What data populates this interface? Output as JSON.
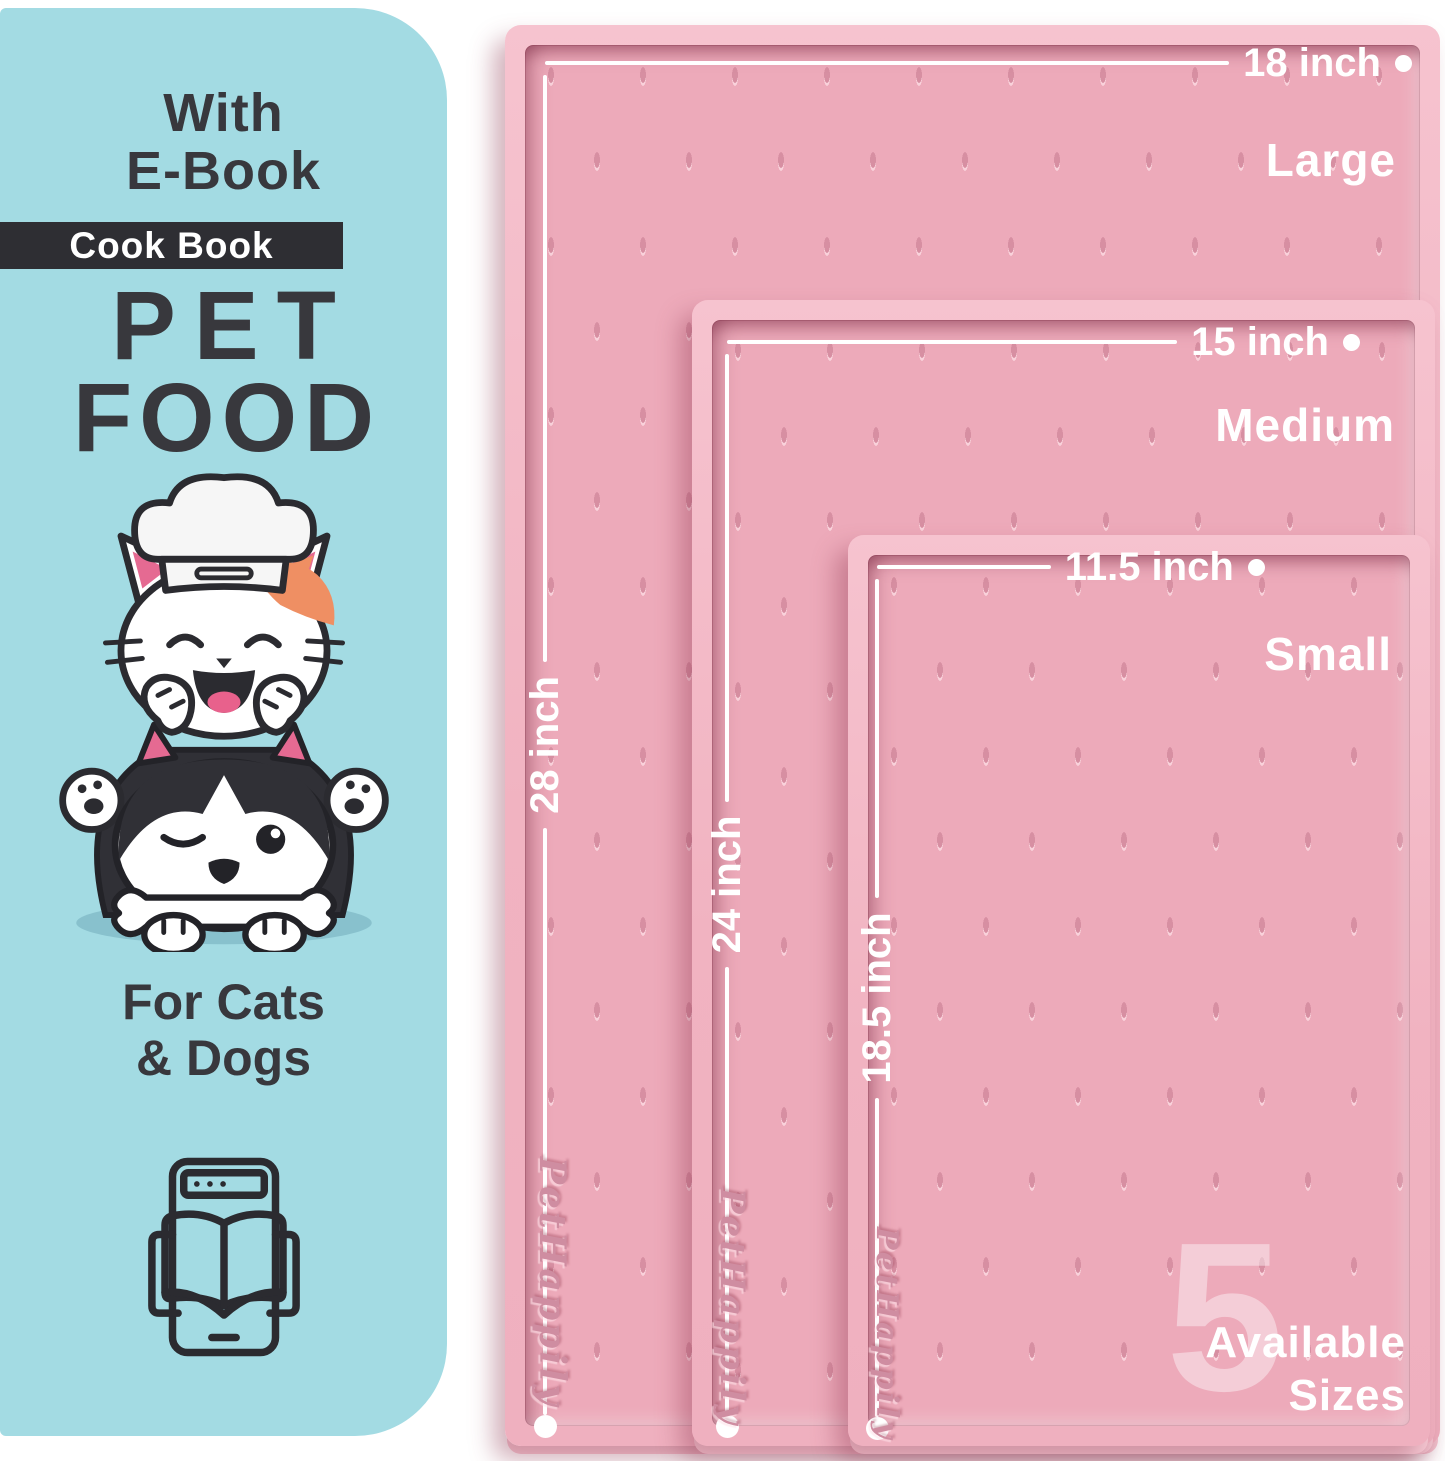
{
  "panel": {
    "ebook_note": {
      "line1": "With",
      "line2": "E-Book"
    },
    "badge_label": "Cook Book",
    "title": {
      "line1": "PET",
      "line2": "FOOD"
    },
    "audience": {
      "line1": "For Cats",
      "line2": "& Dogs"
    },
    "illustration": "cat-chef-and-winking-dog-with-bone",
    "icon": "ebook-reader-icon",
    "background_color": "#a3dbe3",
    "text_color": "#38383d",
    "badge_background": "#2e2e33"
  },
  "mats": [
    {
      "size_label": "Large",
      "width": "18 inch",
      "length": "28 inch",
      "brand": "PetHappily"
    },
    {
      "size_label": "Medium",
      "width": "15 inch",
      "length": "24 inch",
      "brand": "PetHappily"
    },
    {
      "size_label": "Small",
      "width": "11.5 inch",
      "length": "18.5 inch",
      "brand": "PetHappily"
    }
  ],
  "availability": {
    "count": "5",
    "line1": "Available",
    "line2": "Sizes"
  },
  "colors": {
    "mat_surface_pink": "#edaaba",
    "mat_rim_pink": "#f3bac7",
    "dash_pink": "#d78fa2",
    "dimension_white": "#ffffff",
    "brand_emboss_pink": "#cf8da1",
    "cat_patch_orange": "#ef8f63",
    "ear_pink": "#e56a92"
  }
}
